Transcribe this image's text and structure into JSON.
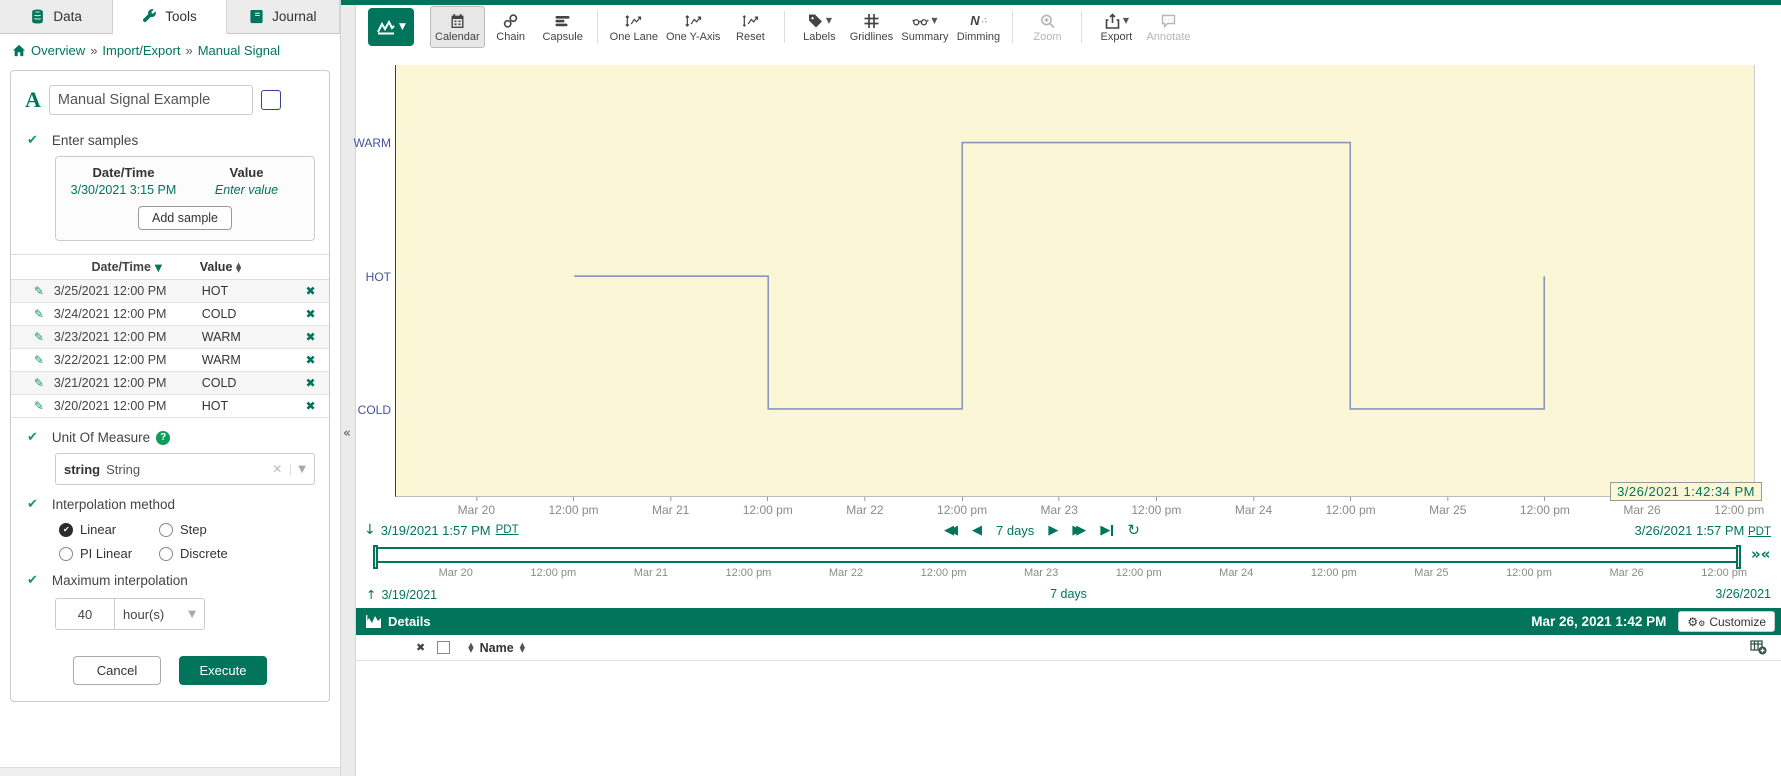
{
  "colors": {
    "accent": "#00755C",
    "check_green": "#0E9D59",
    "plot_bg": "#FBF6D5",
    "signal_line": "#8997BB",
    "axis_label_blue": "#44549E",
    "swatch": "#4A52AD"
  },
  "sidebar": {
    "tabs": [
      {
        "label": "Data"
      },
      {
        "label": "Tools"
      },
      {
        "label": "Journal"
      }
    ],
    "breadcrumb": {
      "items": [
        "Overview",
        "Import/Export",
        "Manual Signal"
      ],
      "separator": "»"
    },
    "form": {
      "name_value": "Manual Signal Example",
      "enter_samples_label": "Enter samples",
      "new_sample": {
        "datetime_header": "Date/Time",
        "value_header": "Value",
        "datetime_value": "3/30/2021 3:15 PM",
        "value_placeholder": "Enter value",
        "add_button": "Add sample"
      },
      "table": {
        "datetime_header": "Date/Time",
        "value_header": "Value",
        "rows": [
          {
            "datetime": "3/25/2021 12:00 PM",
            "value": "HOT"
          },
          {
            "datetime": "3/24/2021 12:00 PM",
            "value": "COLD"
          },
          {
            "datetime": "3/23/2021 12:00 PM",
            "value": "WARM"
          },
          {
            "datetime": "3/22/2021 12:00 PM",
            "value": "WARM"
          },
          {
            "datetime": "3/21/2021 12:00 PM",
            "value": "COLD"
          },
          {
            "datetime": "3/20/2021 12:00 PM",
            "value": "HOT"
          }
        ]
      },
      "uom": {
        "label": "Unit Of Measure",
        "value_code": "string",
        "value_name": "String"
      },
      "interpolation": {
        "label": "Interpolation method",
        "options": [
          {
            "label": "Linear",
            "selected": true
          },
          {
            "label": "Step",
            "selected": false
          },
          {
            "label": "PI Linear",
            "selected": false
          },
          {
            "label": "Discrete",
            "selected": false
          }
        ]
      },
      "max_interpolation": {
        "label": "Maximum interpolation",
        "value": "40",
        "unit": "hour(s)"
      },
      "cancel_button": "Cancel",
      "execute_button": "Execute"
    }
  },
  "toolbar": {
    "buttons": [
      {
        "label": "Calendar"
      },
      {
        "label": "Chain"
      },
      {
        "label": "Capsule"
      },
      {
        "label": "One Lane"
      },
      {
        "label": "One Y-Axis"
      },
      {
        "label": "Reset"
      },
      {
        "label": "Labels"
      },
      {
        "label": "Gridlines"
      },
      {
        "label": "Summary"
      },
      {
        "label": "Dimming"
      },
      {
        "label": "Zoom"
      },
      {
        "label": "Export"
      },
      {
        "label": "Annotate"
      }
    ]
  },
  "chart_data": {
    "type": "line",
    "interpolation": "step-hold",
    "series_name": "Manual Signal Example",
    "y_categories": [
      "WARM",
      "HOT",
      "COLD"
    ],
    "y_levels_pct": {
      "WARM": 18,
      "HOT": 49,
      "COLD": 79.8
    },
    "x_range": [
      "3/19/2021 13:57",
      "3/26/2021 13:57"
    ],
    "points": [
      {
        "t": "3/20/2021 12:00",
        "v": "HOT"
      },
      {
        "t": "3/21/2021 12:00",
        "v": "COLD"
      },
      {
        "t": "3/22/2021 12:00",
        "v": "WARM"
      },
      {
        "t": "3/23/2021 12:00",
        "v": "WARM"
      },
      {
        "t": "3/24/2021 12:00",
        "v": "COLD"
      },
      {
        "t": "3/25/2021 12:00",
        "v": "HOT"
      }
    ],
    "x_ticks": [
      {
        "label": "Mar 20",
        "t": "3/20/2021 00:00"
      },
      {
        "label": "12:00 pm",
        "t": "3/20/2021 12:00"
      },
      {
        "label": "Mar 21",
        "t": "3/21/2021 00:00"
      },
      {
        "label": "12:00 pm",
        "t": "3/21/2021 12:00"
      },
      {
        "label": "Mar 22",
        "t": "3/22/2021 00:00"
      },
      {
        "label": "12:00 pm",
        "t": "3/22/2021 12:00"
      },
      {
        "label": "Mar 23",
        "t": "3/23/2021 00:00"
      },
      {
        "label": "12:00 pm",
        "t": "3/23/2021 12:00"
      },
      {
        "label": "Mar 24",
        "t": "3/24/2021 00:00"
      },
      {
        "label": "12:00 pm",
        "t": "3/24/2021 12:00"
      },
      {
        "label": "Mar 25",
        "t": "3/25/2021 00:00"
      },
      {
        "label": "12:00 pm",
        "t": "3/25/2021 12:00"
      },
      {
        "label": "Mar 26",
        "t": "3/26/2021 00:00"
      },
      {
        "label": "12:00 pm",
        "t": "3/26/2021 12:00"
      }
    ],
    "legend_position": "none",
    "grid": false
  },
  "timebar": {
    "cursor_time": "3/26/2021 1:42:34 PM",
    "start": "3/19/2021 1:57 PM",
    "start_tz": "PDT",
    "end": "3/26/2021 1:57 PM",
    "end_tz": "PDT",
    "duration": "7 days",
    "slider_start": "3/19/2021",
    "slider_end": "3/26/2021",
    "slider_duration": "7 days"
  },
  "details": {
    "title": "Details",
    "timestamp": "Mar 26, 2021 1:42 PM",
    "customize_label": "Customize",
    "name_header": "Name"
  }
}
